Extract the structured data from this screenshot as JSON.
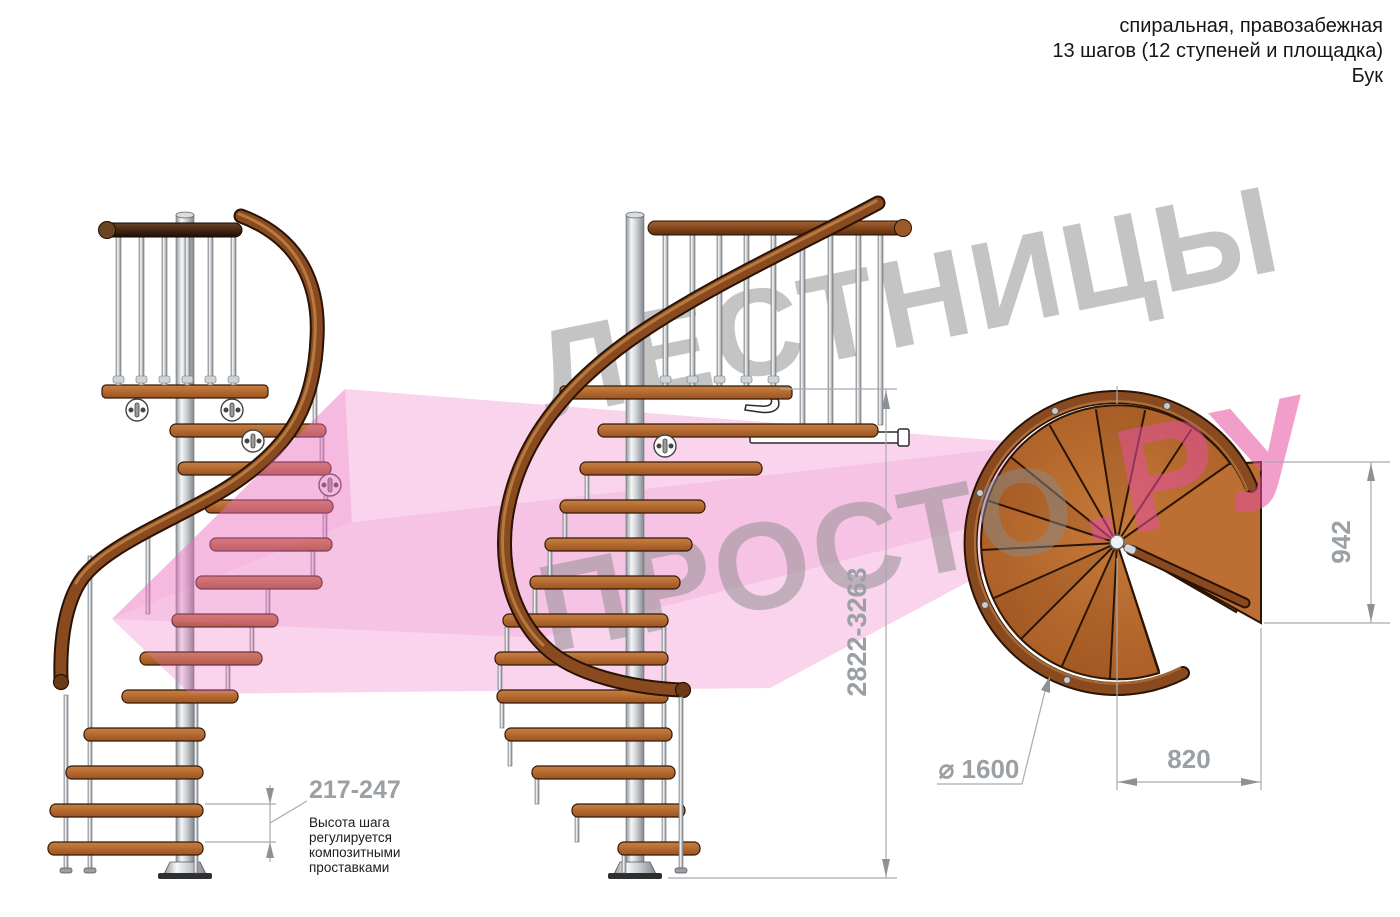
{
  "header": {
    "line1": "спиральная, правозабежная",
    "line2": "13 шагов (12 ступеней и площадка)",
    "line3": "Бук"
  },
  "watermark": {
    "word1": "ЛЕСТНИЦЫ",
    "word2": "ПРОСТО",
    "word3": ".РУ"
  },
  "dimensions": {
    "total_height": "2822-3263",
    "platform_depth": "942",
    "step_width": "820",
    "diameter": "⌀ 1600",
    "step_height": "217-247",
    "step_height_note": [
      "Высота шага",
      "регулируется",
      "композитными",
      "проставками"
    ]
  },
  "colors": {
    "wood": "#b4652e",
    "handrail": "#8a4a1f",
    "dark_rail": "#2e1506",
    "pole": "#c8ccd0",
    "dimension_gray": "#9aa0a4",
    "watermark_gray": "#8a8a8a",
    "watermark_pink": "#e64fa0",
    "arrow_pink": "#ec6fc0"
  }
}
